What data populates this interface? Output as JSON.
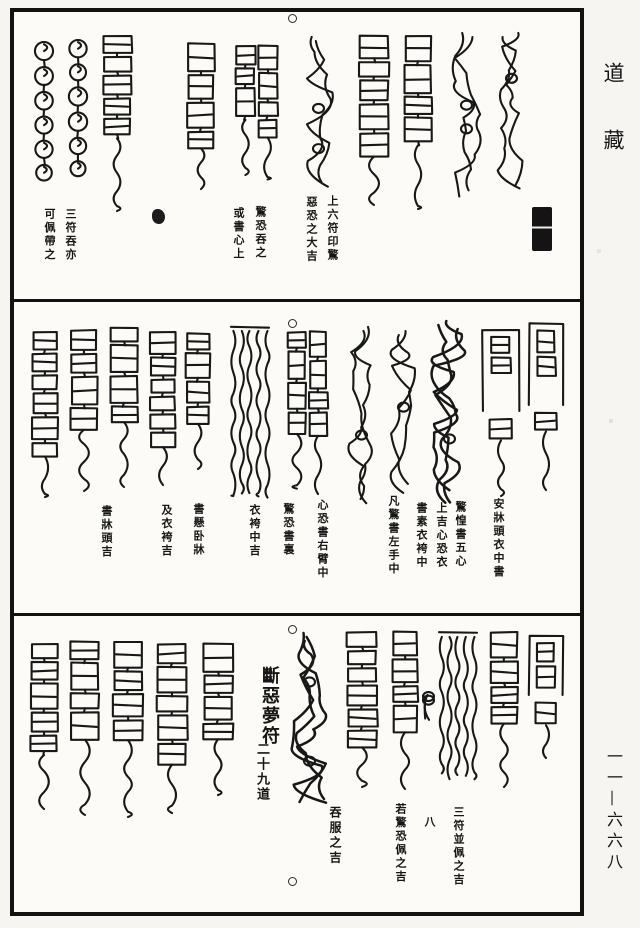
{
  "page": {
    "description": "Woodblock-printed Daoist Canon page of dream/fright talismans in three registers",
    "paper_color": "#fcfbf7",
    "ink_color": "#161616"
  },
  "margin": {
    "collection_title": "道藏",
    "page_number": "一一—六六八"
  },
  "panels": [
    {
      "name": "top-register",
      "captions": [
        {
          "columns": [
            "三符吞亦",
            "可佩帶之"
          ]
        },
        {
          "columns": [
            "驚恐吞之",
            "或書心上"
          ]
        },
        {
          "columns": [
            "上六符印驚",
            "惡恐之大吉"
          ]
        }
      ],
      "seal_stamp": "illegible-black-seal"
    },
    {
      "name": "middle-register",
      "captions": [
        {
          "columns": [
            "書牀頭吉"
          ]
        },
        {
          "columns": [
            "書懸卧牀",
            "及衣袴吉"
          ]
        },
        {
          "columns": [
            "驚恐書裏",
            "衣袴中吉"
          ]
        },
        {
          "columns": [
            "心恐書右臂中"
          ]
        },
        {
          "columns": [
            "凡驚書左手中"
          ]
        },
        {
          "columns": [
            "驚惶書五心",
            "上吉心恐衣",
            "書素衣袴中"
          ]
        },
        {
          "columns": [
            "安牀頭衣中書"
          ]
        }
      ]
    },
    {
      "name": "bottom-register",
      "title": {
        "main": "斷惡夢符",
        "sub": "二十九道"
      },
      "captions": [
        {
          "columns": [
            "吞服之吉"
          ]
        },
        {
          "columns": [
            "若驚恐佩之吉"
          ]
        },
        {
          "columns": [
            "八"
          ]
        },
        {
          "columns": [
            "三符並佩之吉"
          ]
        }
      ]
    }
  ]
}
